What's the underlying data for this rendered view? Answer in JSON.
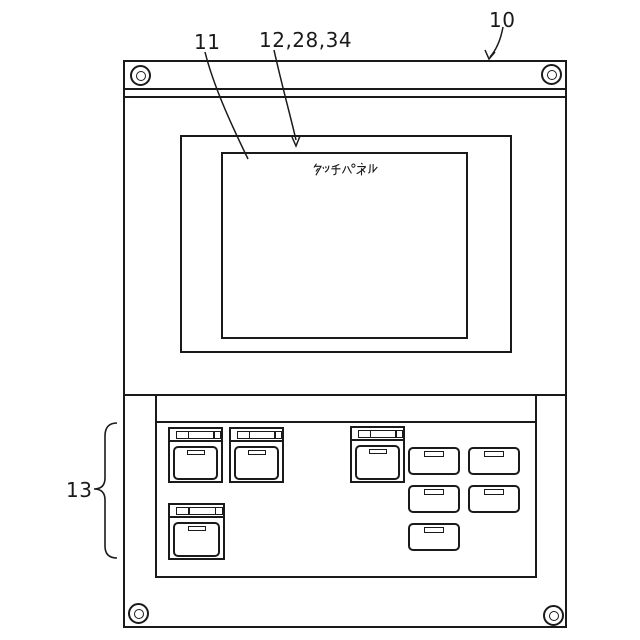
{
  "labels": {
    "device": "10",
    "screen": "11",
    "touch_panel": "12,28,34",
    "key_section": "13"
  },
  "display": {
    "label": "タッチパネル"
  },
  "keypad": {
    "large_key_count": 4,
    "small_key_count": 5
  },
  "style": {
    "ink_color": "#1a1a1a",
    "background_color": "#ffffff"
  }
}
